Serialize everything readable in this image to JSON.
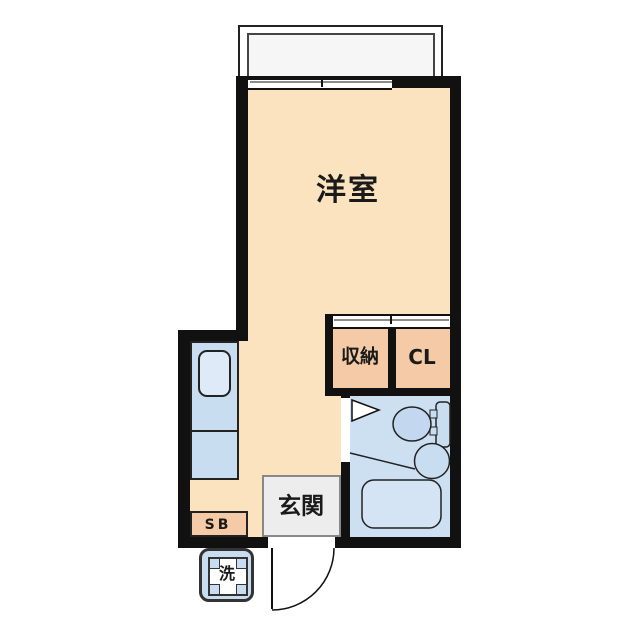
{
  "rooms": {
    "main": {
      "label": "洋室"
    },
    "storage": {
      "label": "収納"
    },
    "closet": {
      "label": "CL"
    },
    "entrance": {
      "label": "玄関"
    },
    "shoebox": {
      "label": "SB"
    },
    "washer": {
      "label": "洗"
    }
  },
  "colors": {
    "wall": "#111111",
    "room_floor": "#FBE3BF",
    "closet_fill": "#F5CBA7",
    "bath_floor": "#CCE0F2",
    "fixture_blue": "#C9DDF1",
    "toilet_bowl": "#C3D8EE",
    "kitchen_sink_fill": "#DEEAF8",
    "bathtub_fill": "#D5E4F5",
    "entrance_fill": "#EDEDED",
    "balcony_fill": "#F6F6F6"
  }
}
